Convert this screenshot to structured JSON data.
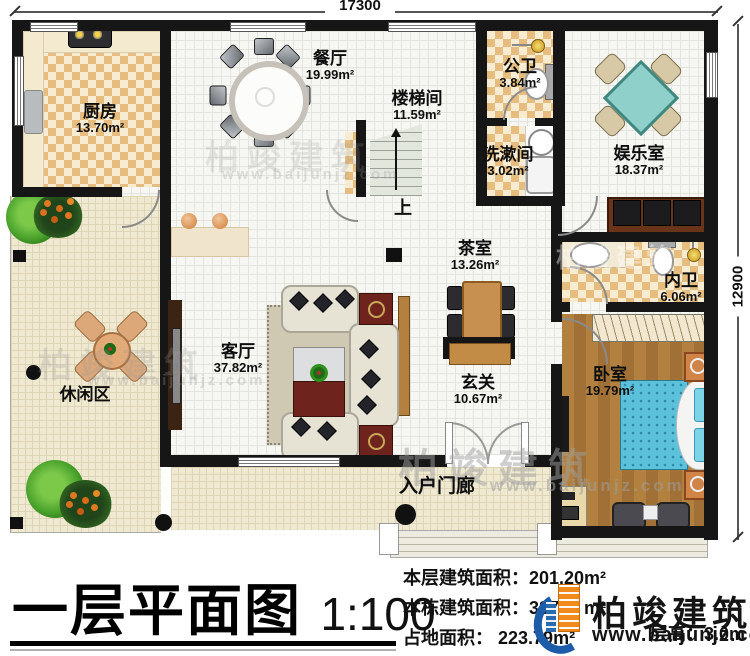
{
  "plan": {
    "title": "一层平面图",
    "scale": "1:100",
    "dim_top": "17300",
    "dim_right": "12900",
    "up": "上"
  },
  "rooms": {
    "kitchen": {
      "name": "厨房",
      "area": "13.70m²"
    },
    "dining": {
      "name": "餐厅",
      "area": "19.99m²"
    },
    "stairwell": {
      "name": "楼梯间",
      "area": "11.59m²"
    },
    "public_bath": {
      "name": "公卫",
      "area": "3.84m²"
    },
    "washroom": {
      "name": "洗漱间",
      "area": "3.02m²"
    },
    "entertainment": {
      "name": "娱乐室",
      "area": "18.37m²"
    },
    "ensuite_bath": {
      "name": "内卫",
      "area": "6.06m²"
    },
    "bedroom": {
      "name": "卧室",
      "area": "19.79m²"
    },
    "tea_room": {
      "name": "茶室",
      "area": "13.26m²"
    },
    "foyer": {
      "name": "玄关",
      "area": "10.67m²"
    },
    "living_room": {
      "name": "客厅",
      "area": "37.82m²"
    },
    "leisure": {
      "name": "休闲区"
    },
    "porch": {
      "name": "入户门廊"
    }
  },
  "stats": {
    "floor": {
      "label": "本层建筑面积：",
      "value": "201.20m²"
    },
    "building": {
      "label": "本栋建筑面积：",
      "value": "387.    m²"
    },
    "footprint": {
      "label": "占地面积：",
      "value": "223.79m²"
    },
    "height": {
      "label": "层高：",
      "value": "3.0m"
    }
  },
  "brand": {
    "name": "柏竣建筑",
    "site": "www.baijunjz.com"
  }
}
